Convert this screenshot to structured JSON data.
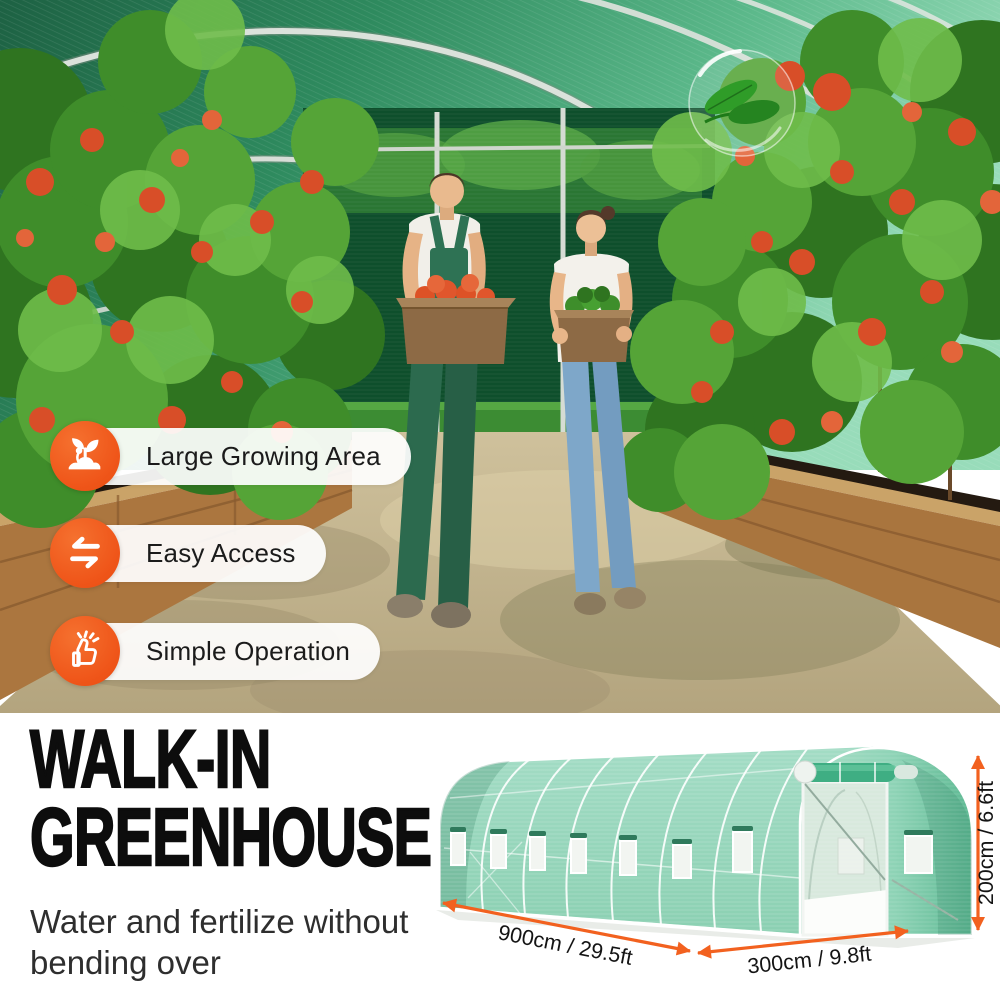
{
  "badges": [
    {
      "label": "Large Growing Area",
      "icon": "sprout"
    },
    {
      "label": "Easy Access",
      "icon": "swap-arrows"
    },
    {
      "label": "Simple Operation",
      "icon": "thumbs-up"
    }
  ],
  "headline": {
    "line1": "WALK-IN",
    "line2": "GREENHOUSE"
  },
  "subtitle": {
    "line1": "Water and fertilize without",
    "line2": "bending over"
  },
  "diagram": {
    "length_label": "900cm / 29.5ft",
    "width_label": "300cm / 9.8ft",
    "height_label": "200cm / 6.6ft"
  },
  "colors": {
    "accent_orange": "#EF5519",
    "arrow_orange": "#F2611F",
    "greenhouse_green": "#97D7BD",
    "roof_green": "#2E8A5E"
  }
}
